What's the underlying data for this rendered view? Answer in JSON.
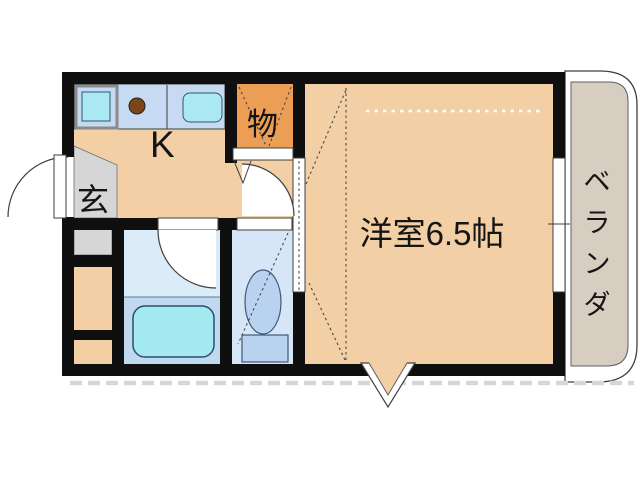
{
  "rooms": {
    "kitchen": {
      "label": "K"
    },
    "entrance": {
      "label": "玄"
    },
    "storage_closet": {
      "label": "物"
    },
    "main_room": {
      "label": "洋室6.5帖"
    },
    "veranda": {
      "label": "ベランダ"
    }
  },
  "fixtures": [
    "washing-machine-icon",
    "stove-burner-icon",
    "kitchen-sink-icon",
    "bathtub-icon",
    "toilet-icon",
    "entrance-door-arc",
    "bathroom-door-arc",
    "toilet-door-arc",
    "closet-folding-door",
    "main-room-sliding-door",
    "sliding-window",
    "direction-triangle-marker"
  ],
  "colors": {
    "wall": "#0f0f0f",
    "floor": "#f3cfa6",
    "genkan": "#d6d6d6",
    "closet": "#ec9e55",
    "counter": "#c7daf3",
    "sink": "#aae8f2",
    "burner": "#7b4517",
    "bathroom": "#dcebf8",
    "tub_zone": "#c1d8f1",
    "tub": "#a4e8f0",
    "toilet_room": "#d6e6f6",
    "toilet_fixture": "#b8d2ef",
    "veranda": "#d8cdc1",
    "line": "#3f3f3f",
    "dash_gray": "#d7d7d7",
    "bg": "#ffffff"
  }
}
